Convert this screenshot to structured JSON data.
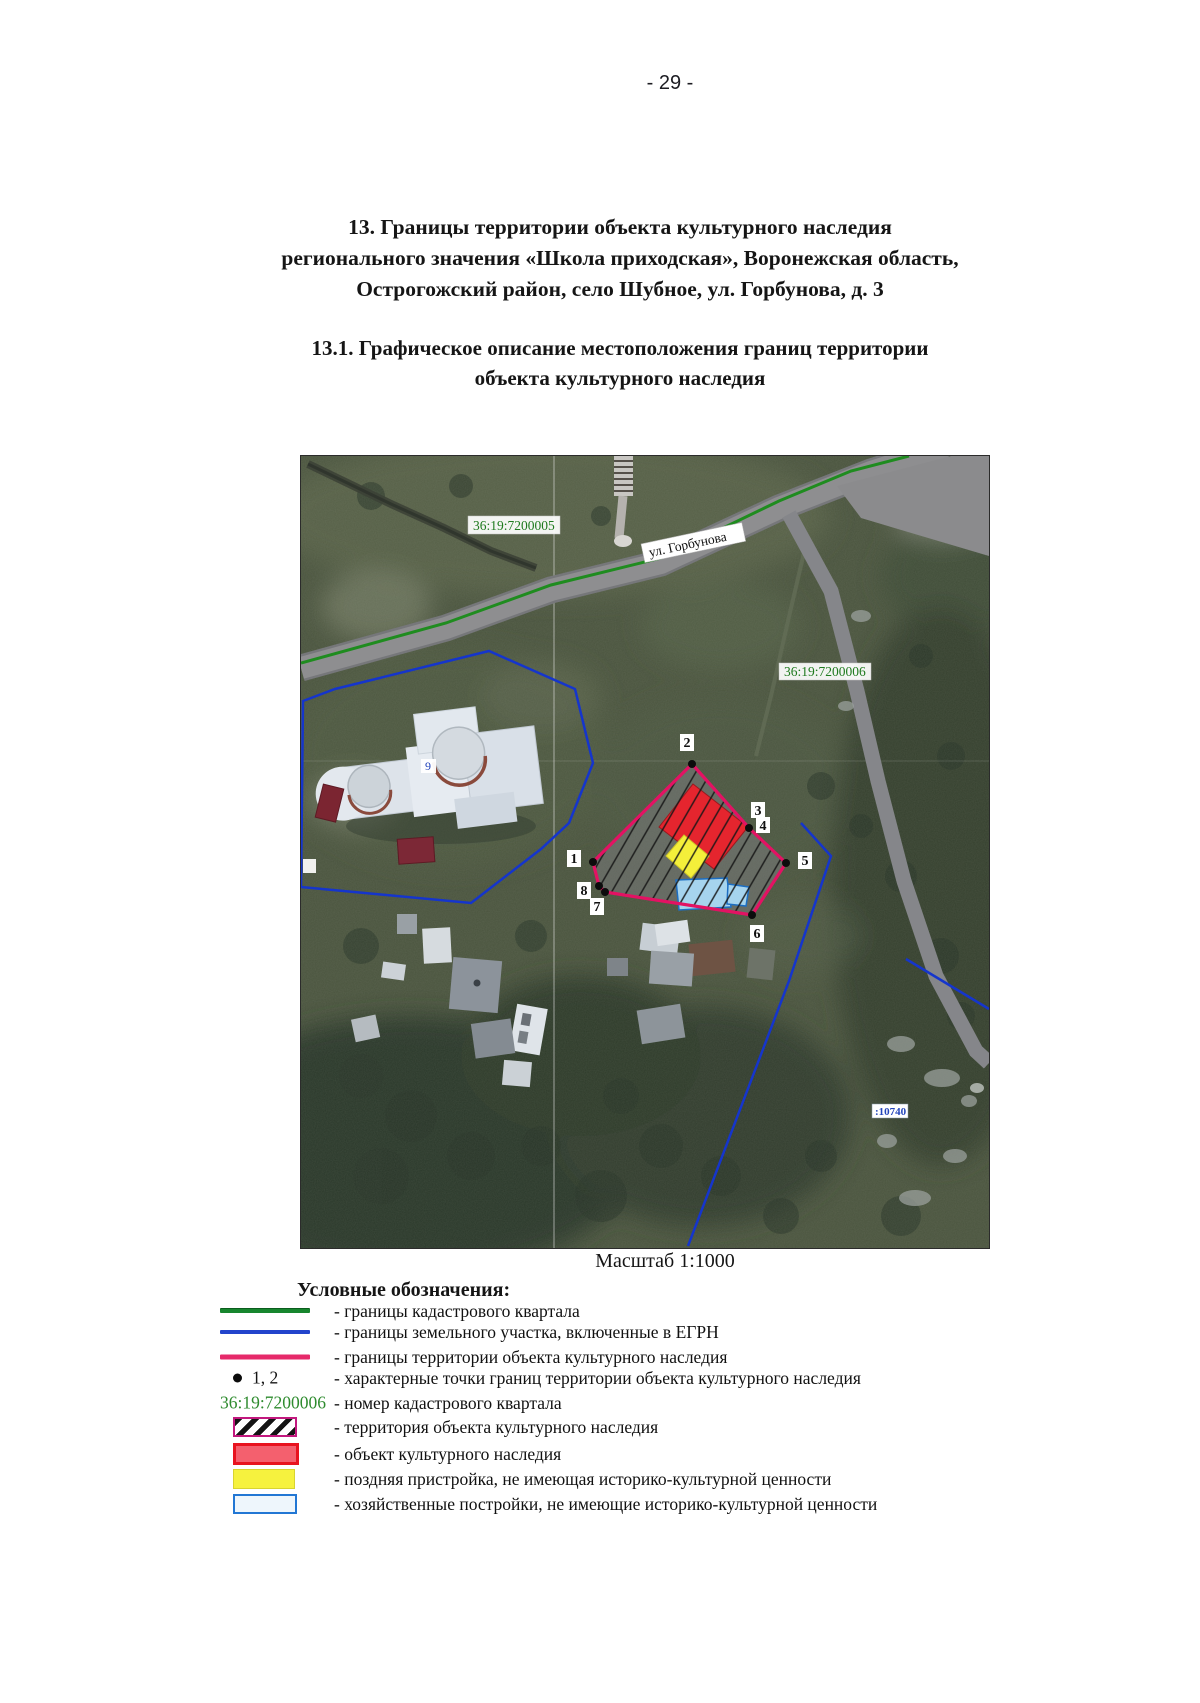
{
  "page": {
    "number": "- 29 -"
  },
  "headings": {
    "section": {
      "line1": "13.    Границы территории объекта культурного наследия",
      "line2": "регионального значения «Школа приходская», Воронежская область,",
      "line3": "Острогожский район, село Шубное, ул. Горбунова, д. 3"
    },
    "subsection": {
      "line1": "13.1.  Графическое описание местоположения границ территории",
      "line2": "объекта культурного наследия"
    }
  },
  "map": {
    "caption": "Масштаб 1:1000",
    "cadastral_labels": {
      "quarter_top_left": "36:19:7200005",
      "quarter_right": "36:19:7200006",
      "parcel_bottom_right": ":10740"
    },
    "street_label": "ул. Горбунова",
    "building_label": "9",
    "points": [
      "1",
      "2",
      "3",
      "4",
      "5",
      "6",
      "7",
      "8"
    ]
  },
  "legend": {
    "title": "Условные обозначения:",
    "point_sample": "1, 2",
    "cad_number_sample": "36:19:7200006",
    "items": [
      {
        "swatch": "line-green",
        "label": "- границы кадастрового квартала"
      },
      {
        "swatch": "line-blue",
        "label": "- границы земельного участка, включенные в ЕГРН"
      },
      {
        "swatch": "line-pink",
        "label": "- границы территории объекта культурного наследия"
      },
      {
        "swatch": "point",
        "label": "- характерные точки границ территории объекта культурного наследия"
      },
      {
        "swatch": "cad-number",
        "label": "- номер кадастрового квартала"
      },
      {
        "swatch": "box-hatch",
        "label": "- территория объекта культурного наследия"
      },
      {
        "swatch": "box-red",
        "label": "- объект культурного наследия"
      },
      {
        "swatch": "box-yellow",
        "label": "- поздняя пристройка, не имеющая историко-культурной ценности"
      },
      {
        "swatch": "box-blue",
        "label": "- хозяйственные постройки, не имеющие историко-культурной ценности"
      }
    ]
  },
  "colors": {
    "cadastral_quarter_line": "#1f8c1f",
    "parcel_line": "#1535cc",
    "heritage_boundary_line": "#e31263",
    "heritage_object_fill": "#e5252e",
    "late_annex_fill": "#f4ef3a",
    "outbuilding_fill": "#a6d4ee",
    "cadastral_label_text": "#1e7a1e",
    "parcel_label_text": "#2244bb"
  }
}
